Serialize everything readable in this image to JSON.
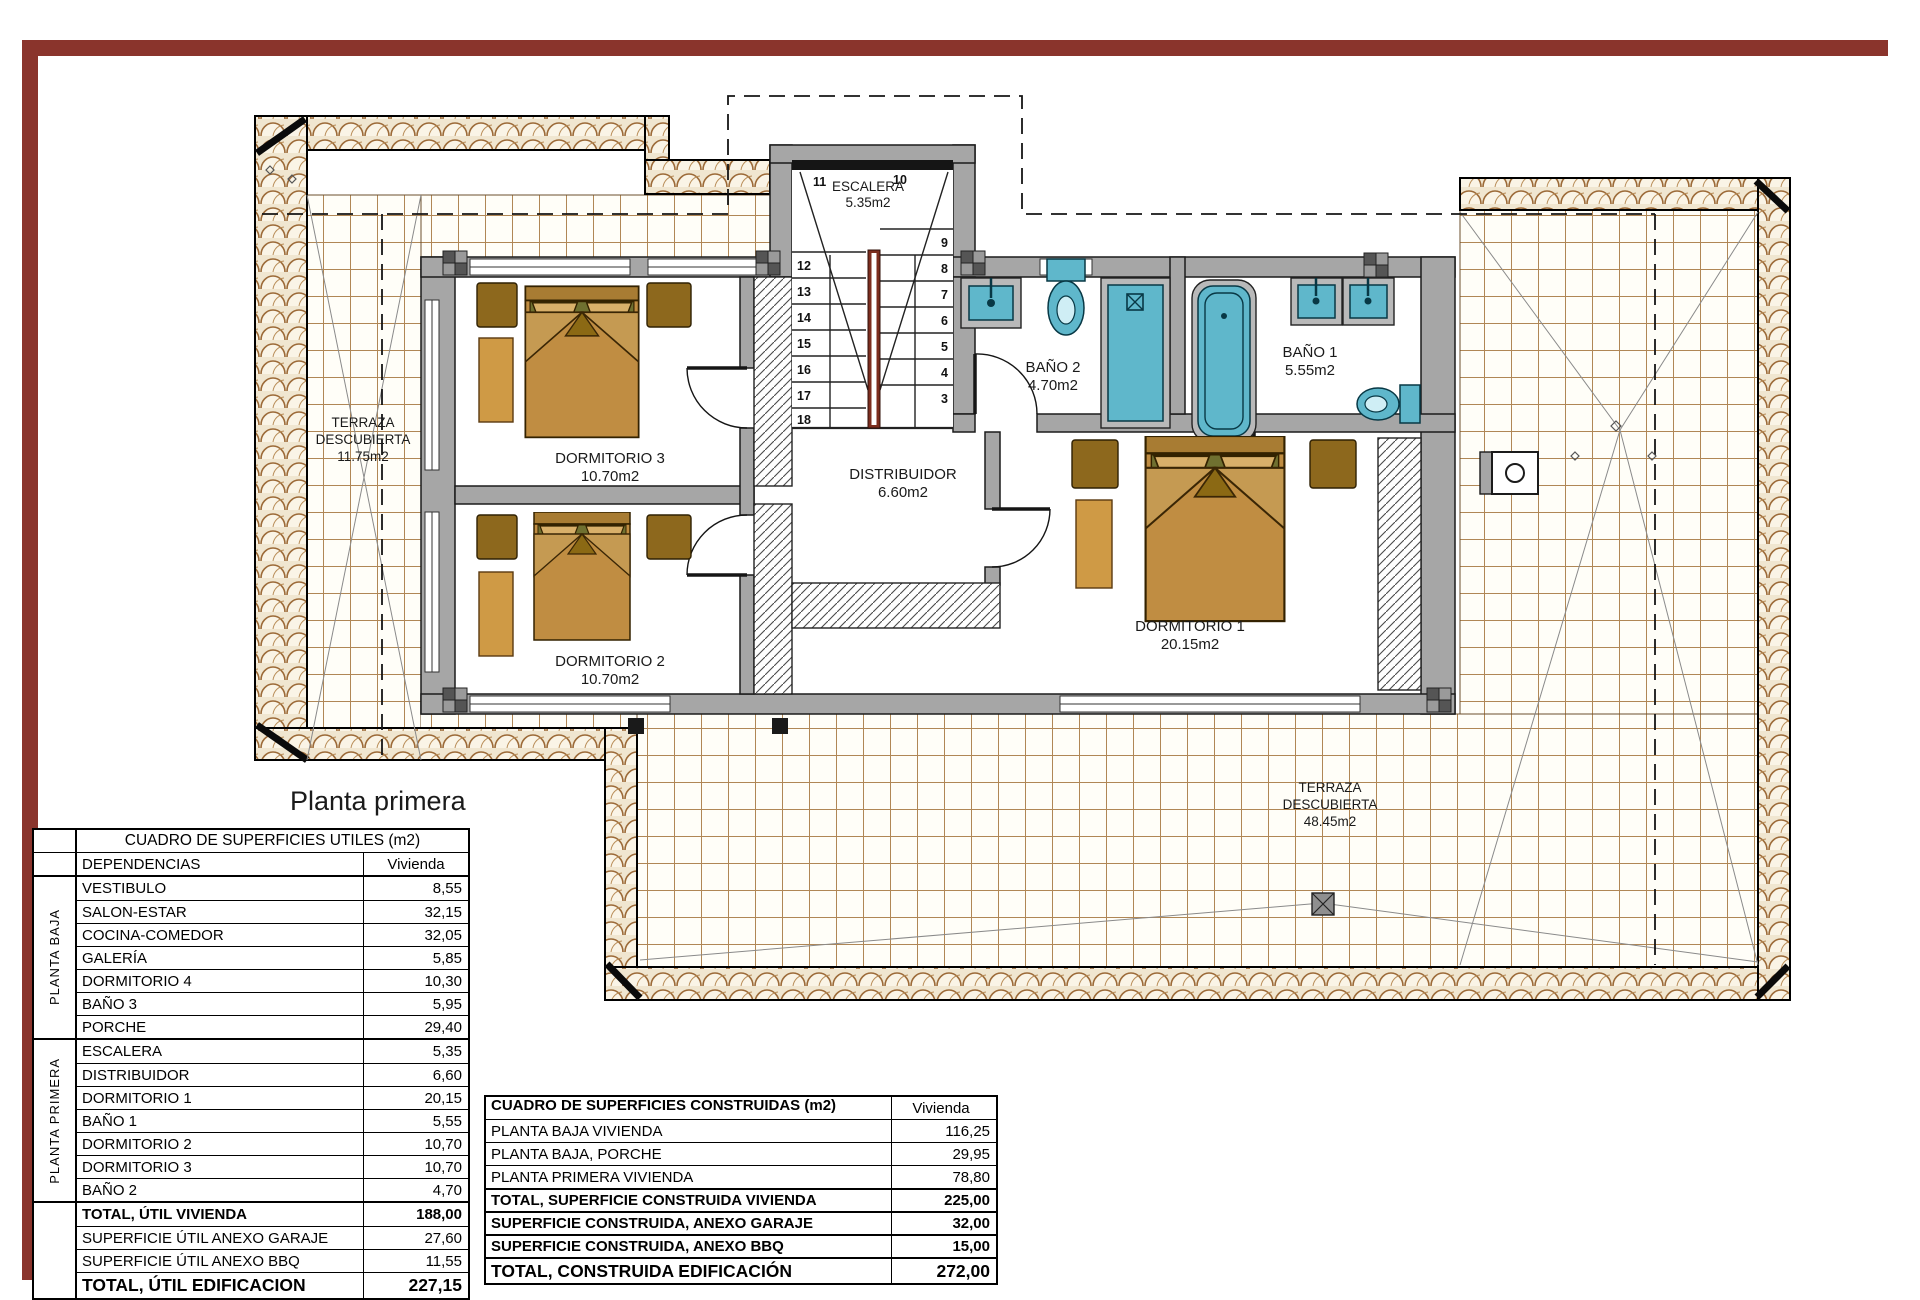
{
  "title": "Planta primera",
  "colors": {
    "frame": "#8a342c",
    "wall": "#a6a6a6",
    "fixture": "#5fb7cb",
    "bed": "#c08d42",
    "rail": "#7c2d1e"
  },
  "plan": {
    "rooms": {
      "escalera": {
        "name": "ESCALERA",
        "area": "5.35m2"
      },
      "distribuidor": {
        "name": "DISTRIBUIDOR",
        "area": "6.60m2"
      },
      "dormitorio3": {
        "name": "DORMITORIO 3",
        "area": "10.70m2"
      },
      "dormitorio2": {
        "name": "DORMITORIO 2",
        "area": "10.70m2"
      },
      "dormitorio1": {
        "name": "DORMITORIO 1",
        "area": "20.15m2"
      },
      "bano2": {
        "name": "BAÑO 2",
        "area": "4.70m2"
      },
      "bano1": {
        "name": "BAÑO 1",
        "area": "5.55m2"
      },
      "terraza_izq": {
        "line1": "TERRAZA",
        "line2": "DESCUBIERTA",
        "area": "11.75m2"
      },
      "terraza_der": {
        "line1": "TERRAZA",
        "line2": "DESCUBIERTA",
        "area": "48.45m2"
      }
    },
    "stairs": {
      "top": [
        "11",
        "10"
      ],
      "left": [
        "12",
        "13",
        "14",
        "15",
        "16",
        "17",
        "18"
      ],
      "right": [
        "9",
        "8",
        "7",
        "6",
        "5",
        "4",
        "3"
      ]
    }
  },
  "tables": {
    "utiles": {
      "title": "CUADRO DE SUPERFICIES UTILES (m2)",
      "col_rooms": "DEPENDENCIAS",
      "col_value": "Vivienda",
      "groups": [
        {
          "label": "PLANTA BAJA",
          "rows": [
            [
              "VESTIBULO",
              "8,55"
            ],
            [
              "SALON-ESTAR",
              "32,15"
            ],
            [
              "COCINA-COMEDOR",
              "32,05"
            ],
            [
              "GALERÍA",
              "5,85"
            ],
            [
              "DORMITORIO 4",
              "10,30"
            ],
            [
              "BAÑO 3",
              "5,95"
            ],
            [
              "PORCHE",
              "29,40"
            ]
          ]
        },
        {
          "label": "PLANTA PRIMERA",
          "rows": [
            [
              "ESCALERA",
              "5,35"
            ],
            [
              "DISTRIBUIDOR",
              "6,60"
            ],
            [
              "DORMITORIO 1",
              "20,15"
            ],
            [
              "BAÑO 1",
              "5,55"
            ],
            [
              "DORMITORIO 2",
              "10,70"
            ],
            [
              "DORMITORIO 3",
              "10,70"
            ],
            [
              "BAÑO 2",
              "4,70"
            ]
          ]
        }
      ],
      "totals": [
        [
          "TOTAL, ÚTIL VIVIENDA",
          "188,00"
        ],
        [
          "SUPERFICIE ÚTIL ANEXO GARAJE",
          "27,60"
        ],
        [
          "SUPERFICIE ÚTIL ANEXO BBQ",
          "11,55"
        ],
        [
          "TOTAL, ÚTIL EDIFICACION",
          "227,15"
        ]
      ]
    },
    "construidas": {
      "title": "CUADRO DE SUPERFICIES CONSTRUIDAS (m2)",
      "col_value": "Vivienda",
      "rows": [
        [
          "PLANTA BAJA VIVIENDA",
          "116,25"
        ],
        [
          "PLANTA BAJA, PORCHE",
          "29,95"
        ],
        [
          "PLANTA PRIMERA VIVIENDA",
          "78,80"
        ]
      ],
      "totals": [
        [
          "TOTAL, SUPERFICIE CONSTRUIDA VIVIENDA",
          "225,00"
        ],
        [
          "SUPERFICIE CONSTRUIDA, ANEXO GARAJE",
          "32,00"
        ],
        [
          "SUPERFICIE CONSTRUIDA, ANEXO BBQ",
          "15,00"
        ],
        [
          "TOTAL, CONSTRUIDA EDIFICACIÓN",
          "272,00"
        ]
      ]
    }
  }
}
